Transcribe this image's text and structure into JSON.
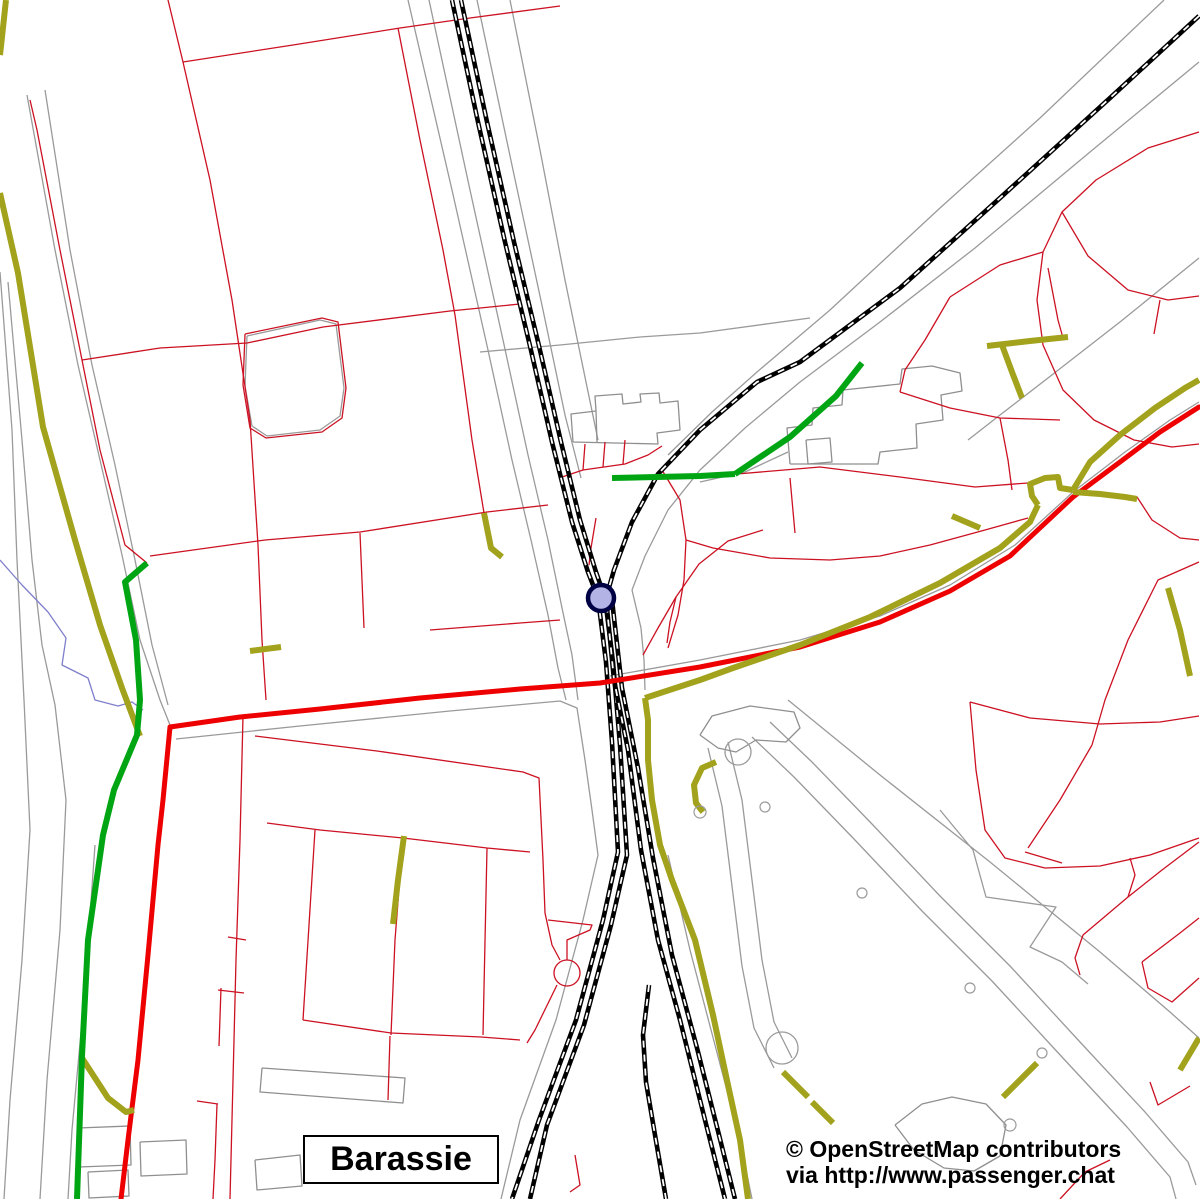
{
  "place_label": "Barassie",
  "attribution": {
    "line1": "© OpenStreetMap contributors",
    "line2": "via http://www.passenger.chat"
  },
  "canvas": {
    "width": 1200,
    "height": 1199,
    "background": "#ffffff"
  },
  "colors": {
    "boundary_gray": "#9a9a9a",
    "building_gray": "#8f8f8f",
    "stream_blue": "#7f7fcc",
    "plot_red": "#cc1122",
    "road_red": "#ee0000",
    "track_olive": "#a2a21c",
    "footpath_green": "#00a513",
    "railway_black": "#000000",
    "railway_dash_white": "#ffffff",
    "station_fill": "#b3b3e6",
    "station_stroke": "#000044"
  },
  "map_layers": [
    {
      "name": "gray-boundaries",
      "color": "#9a9a9a",
      "width": 1.3,
      "lines": [
        "408,0 452,190 488,350 512,460 531,540 548,615 558,668 566,700",
        "429,0 470,190 503,340 528,455 548,540 562,608 572,655 578,700",
        "477,0 513,170 543,310 565,415 581,478",
        "510,0 540,150 565,280 586,382 598,440",
        "1164,0 1040,118 940,208 830,310 757,372 712,412 668,455",
        "1199,62 1090,152 975,248 880,322 800,382 745,428 700,470 668,510 645,556 632,590",
        "27,95 55,250 78,365 100,460 122,555 140,640 160,700 172,730",
        "45,90 70,250 92,365 115,465 135,560 152,645 168,705",
        "0,272 12,430 17,560 24,700 30,830 22,960 10,1100 4,1199",
        "8,282 22,440 32,560 42,645 55,705 66,800 60,930 47,1080 40,1199",
        "95,845 84,1000 72,1130 68,1199",
        "176,739 300,726 450,711 560,701 577,708 585,760 592,810 598,855 583,920 556,1020 520,1120 501,1199",
        "610,676 700,660 800,640 880,616 950,585 1015,545 1073,492 1125,452 1170,420 1199,402",
        "1199,258 1120,322 1048,378 1000,415 968,440",
        "668,855 690,950 715,1045 740,1140 752,1199",
        "788,700 880,775 990,862 1100,952 1170,1012 1199,1038",
        "940,810 973,850 986,897 1056,907 1030,947 1062,962 1088,984",
        "770,722 812,762 872,824 940,896 1010,966 1080,1042 1145,1112 1188,1162 1196,1185",
        "752,737 794,777 854,839 922,911 992,981 1062,1057 1127,1127 1170,1177 1176,1199",
        "728,742 742,800 752,880 762,960 774,1022 792,1058",
        "708,748 722,806 732,886 742,966 754,1028 774,1068",
        "247,336 320,320 336,324 344,388 340,416 320,430 267,436 252,426 245,386 247,336",
        "480,352 560,345 640,337 700,333 810,318",
        "632,590 641,628 644,660 645,690",
        "700,482 745,472 788,452"
      ]
    },
    {
      "name": "gray-buildings",
      "color": "#8f8f8f",
      "width": 1.3,
      "lines": [
        "573,442 571,414 596,411 595,396 622,394 623,404 641,402 640,394 659,393 660,403 678,401 680,430 657,433 658,444 573,442",
        "596,411 597,442",
        "790,464 787,428 812,425 813,408 842,405 843,390 900,384 902,369 932,366 960,373 962,391 941,395 943,420 916,424 917,448 880,452 878,464 790,464",
        "806,440 830,438 832,462 808,464 806,440",
        "700,735 712,716 750,706 794,712 800,728 786,742 756,740 736,752 718,748 700,735",
        "895,1125 922,1104 952,1097 986,1104 1006,1125 1000,1156 974,1171 944,1168 914,1150 895,1125",
        "262,1068 405,1078 403,1103 260,1092 262,1068",
        "78,1128 130,1126 131,1165 79,1167 78,1128",
        "140,1142 186,1140 187,1174 141,1176 140,1142",
        "88,1172 128,1170 129,1196 89,1198 88,1172",
        "255,1160 300,1155 302,1186 257,1190 255,1160"
      ]
    },
    {
      "name": "stream",
      "color": "#7f7fcc",
      "width": 1.3,
      "lines": [
        "0,560 22,585 48,612 66,638 62,665 88,678 95,700 118,706 132,702 143,710"
      ]
    },
    {
      "name": "plot-boundaries-red",
      "color": "#cc1122",
      "width": 1.3,
      "lines": [
        "30,100 37,130 60,250 82,360 100,450 125,545 147,563",
        "168,0 183,62 293,45 400,28 470,18 560,6",
        "183,62 210,180 232,300 250,420 258,545 262,640 266,700",
        "398,28 420,140 443,250 455,315 472,440 484,513",
        "82,360 160,348 247,343 323,327 450,311 520,304",
        "245,334 322,318 338,322 346,388 342,418 322,432 266,438 250,428 243,385 245,334",
        "150,556 265,540 360,532 487,512 548,505",
        "360,533 364,628",
        "430,630 520,623 560,620",
        "596,518 591,548 589,565",
        "562,477 583,470 625,464 648,455 662,446",
        "585,444 583,470",
        "605,442 603,467",
        "625,440 623,464",
        "643,655 658,628 676,597 699,564 728,541 763,530",
        "676,597 670,622 667,643",
        "662,470 680,500 686,540 684,580 678,615 668,648",
        "686,540 713,548 770,558 830,560 880,556 930,545 985,530 1028,518",
        "737,474 820,467 900,477 975,487 1028,483",
        "790,478 795,533",
        "1199,132 1148,148 1096,180 1062,212 1043,252 1037,300 1043,345 1063,390 1094,420 1134,440 1172,447 1199,444",
        "1062,212 1088,256 1128,290 1168,300 1199,296",
        "1160,300 1154,334",
        "950,297 1000,265 1043,252",
        "1048,268 1058,320 1063,338",
        "950,297 925,340 905,370 900,392",
        "900,392 950,408 1000,418 1060,420",
        "1000,418 1008,460 1012,490",
        "1137,497 1152,520 1180,538 1199,540",
        "1199,562 1158,580 1128,640 1105,700 1092,745",
        "1092,745 1060,800 1028,848",
        "1025,852 1062,863",
        "1083,935 1128,897 1162,870 1199,842",
        "1128,897 1135,875 1130,858",
        "1083,935 1075,958 1080,975",
        "1142,962 1180,933 1199,918",
        "1142,962 1148,988 1172,1002 1199,978",
        "1150,1082 1158,1105 1190,1086",
        "970,702 976,770 985,830 1005,858 1045,868 1100,866 1150,855 1199,838",
        "970,702 1030,718 1100,724 1160,722 1199,716",
        "243,716 240,840 236,960 233,1080 230,1199",
        "228,937 246,940",
        "218,990 244,993",
        "221,988 219,1046",
        "197,1101 218,1104",
        "217,1104 215,1160 213,1199",
        "255,736 377,751 523,772 539,778 543,860 545,913 552,945 560,960",
        "267,823 320,830 403,838 487,848 530,852",
        "315,830 303,1020",
        "403,838 395,940 391,1035",
        "487,848 483,1035",
        "303,1020 391,1033 481,1037 520,1040",
        "390,1036 388,1100",
        "567,960 567,940 590,930 592,925 548,920",
        "557,985 535,1030 527,1043",
        "575,1155 580,1185 570,1192",
        "1060,1199 1085,1172 1110,1160"
      ]
    },
    {
      "name": "railway-tracks",
      "color": "#000000",
      "width": 4.6,
      "overlay": {
        "color": "#ffffff",
        "width": 1.8,
        "dash": "7 7"
      },
      "lines": [
        "452,0 478,122 505,242 530,346 552,442 572,522 588,572 598,598 606,662 612,742 618,852 603,920 576,1020 539,1120 512,1199",
        "461,0 487,122 514,242 539,346 561,442 580,520 596,572 605,598 613,662 620,745 627,855 611,925 584,1025 547,1125 530,1199",
        "1199,16 1110,98 1000,198 900,288 800,362 757,382 700,430 658,474 632,522 614,570 606,598 614,680 628,750 641,850 658,940 680,1020 705,1120 725,1199",
        "612,600 622,688 638,768 653,858 672,955 697,1048 719,1135 735,1199",
        "649,985 643,1035 646,1082 655,1135 666,1199"
      ]
    },
    {
      "name": "road-main-red",
      "color": "#ee0000",
      "width": 5,
      "linecap": "round",
      "lines": [
        "170,727 240,717 320,709 420,698 520,689 600,683 700,667 800,647 880,622 950,591 1010,556 1073,497 1120,462 1160,432 1199,407",
        "170,727 163,800 158,845 148,955 138,1060 128,1140 121,1199"
      ]
    },
    {
      "name": "track-olive-paths",
      "color": "#a2a21c",
      "width": 6,
      "lines": [
        "6,0 0,55",
        "0,193 18,273 43,427 75,540 100,625 122,688 140,736",
        "645,698 700,680 733,668 800,645 870,617 940,583 1000,548 1030,522 1038,505",
        "1038,505 1032,496 1030,484 1045,478 1058,477 1060,488 1073,490",
        "1073,490 1090,462 1120,435 1155,408 1185,388 1199,380",
        "1073,492 1100,494 1125,497 1137,499",
        "980,528 952,516",
        "645,698 648,720 648,760 652,800 660,845 672,880 695,940 713,1015 728,1085 740,1140 748,1199",
        "716,762 702,768 694,785 696,803 703,812",
        "484,513 491,548 502,557",
        "250,651 281,647",
        "404,836 398,880 393,924",
        "987,346 1030,341 1068,337",
        "1002,345 1012,372 1022,398",
        "783,1072 808,1097",
        "812,1102 833,1123",
        "1003,1097 1037,1063",
        "1168,588 1180,630 1190,676",
        "1180,1070 1199,1038",
        "82,1058 108,1098 126,1112 134,1110"
      ]
    },
    {
      "name": "footpath-green",
      "color": "#00a513",
      "width": 6,
      "lines": [
        "147,563 125,582 136,640 140,700 137,735 114,790 103,835 88,940 82,1056 77,1199",
        "612,478 700,476 735,474",
        "735,474 790,437 836,396 862,363"
      ]
    }
  ],
  "map_circles": [
    {
      "name": "golf-feature-circle",
      "cx": 738,
      "cy": 752,
      "r": 13,
      "stroke": "#9a9a9a",
      "sw": 1.3,
      "fill": "none"
    },
    {
      "name": "golf-feature-circle",
      "cx": 782,
      "cy": 1048,
      "r": 16,
      "stroke": "#9a9a9a",
      "sw": 1.3,
      "fill": "none"
    },
    {
      "name": "golf-feature-circle",
      "cx": 765,
      "cy": 807,
      "r": 5,
      "stroke": "#9a9a9a",
      "sw": 1.2,
      "fill": "none"
    },
    {
      "name": "golf-feature-circle",
      "cx": 862,
      "cy": 893,
      "r": 5,
      "stroke": "#9a9a9a",
      "sw": 1.2,
      "fill": "none"
    },
    {
      "name": "golf-feature-circle",
      "cx": 970,
      "cy": 988,
      "r": 5,
      "stroke": "#9a9a9a",
      "sw": 1.2,
      "fill": "none"
    },
    {
      "name": "golf-feature-circle",
      "cx": 1042,
      "cy": 1053,
      "r": 5,
      "stroke": "#9a9a9a",
      "sw": 1.2,
      "fill": "none"
    },
    {
      "name": "golf-feature-circle",
      "cx": 700,
      "cy": 812,
      "r": 6,
      "stroke": "#9a9a9a",
      "sw": 1.2,
      "fill": "none"
    },
    {
      "name": "golf-feature-circle",
      "cx": 1010,
      "cy": 1125,
      "r": 6,
      "stroke": "#9a9a9a",
      "sw": 1.2,
      "fill": "none"
    },
    {
      "name": "pond-outline",
      "cx": 567,
      "cy": 973,
      "r": 13,
      "stroke": "#cc1122",
      "sw": 1.3,
      "fill": "none"
    },
    {
      "name": "station-marker",
      "cx": 601,
      "cy": 598,
      "r": 13,
      "stroke": "#000044",
      "sw": 4.5,
      "fill": "#b3b3e6"
    }
  ]
}
